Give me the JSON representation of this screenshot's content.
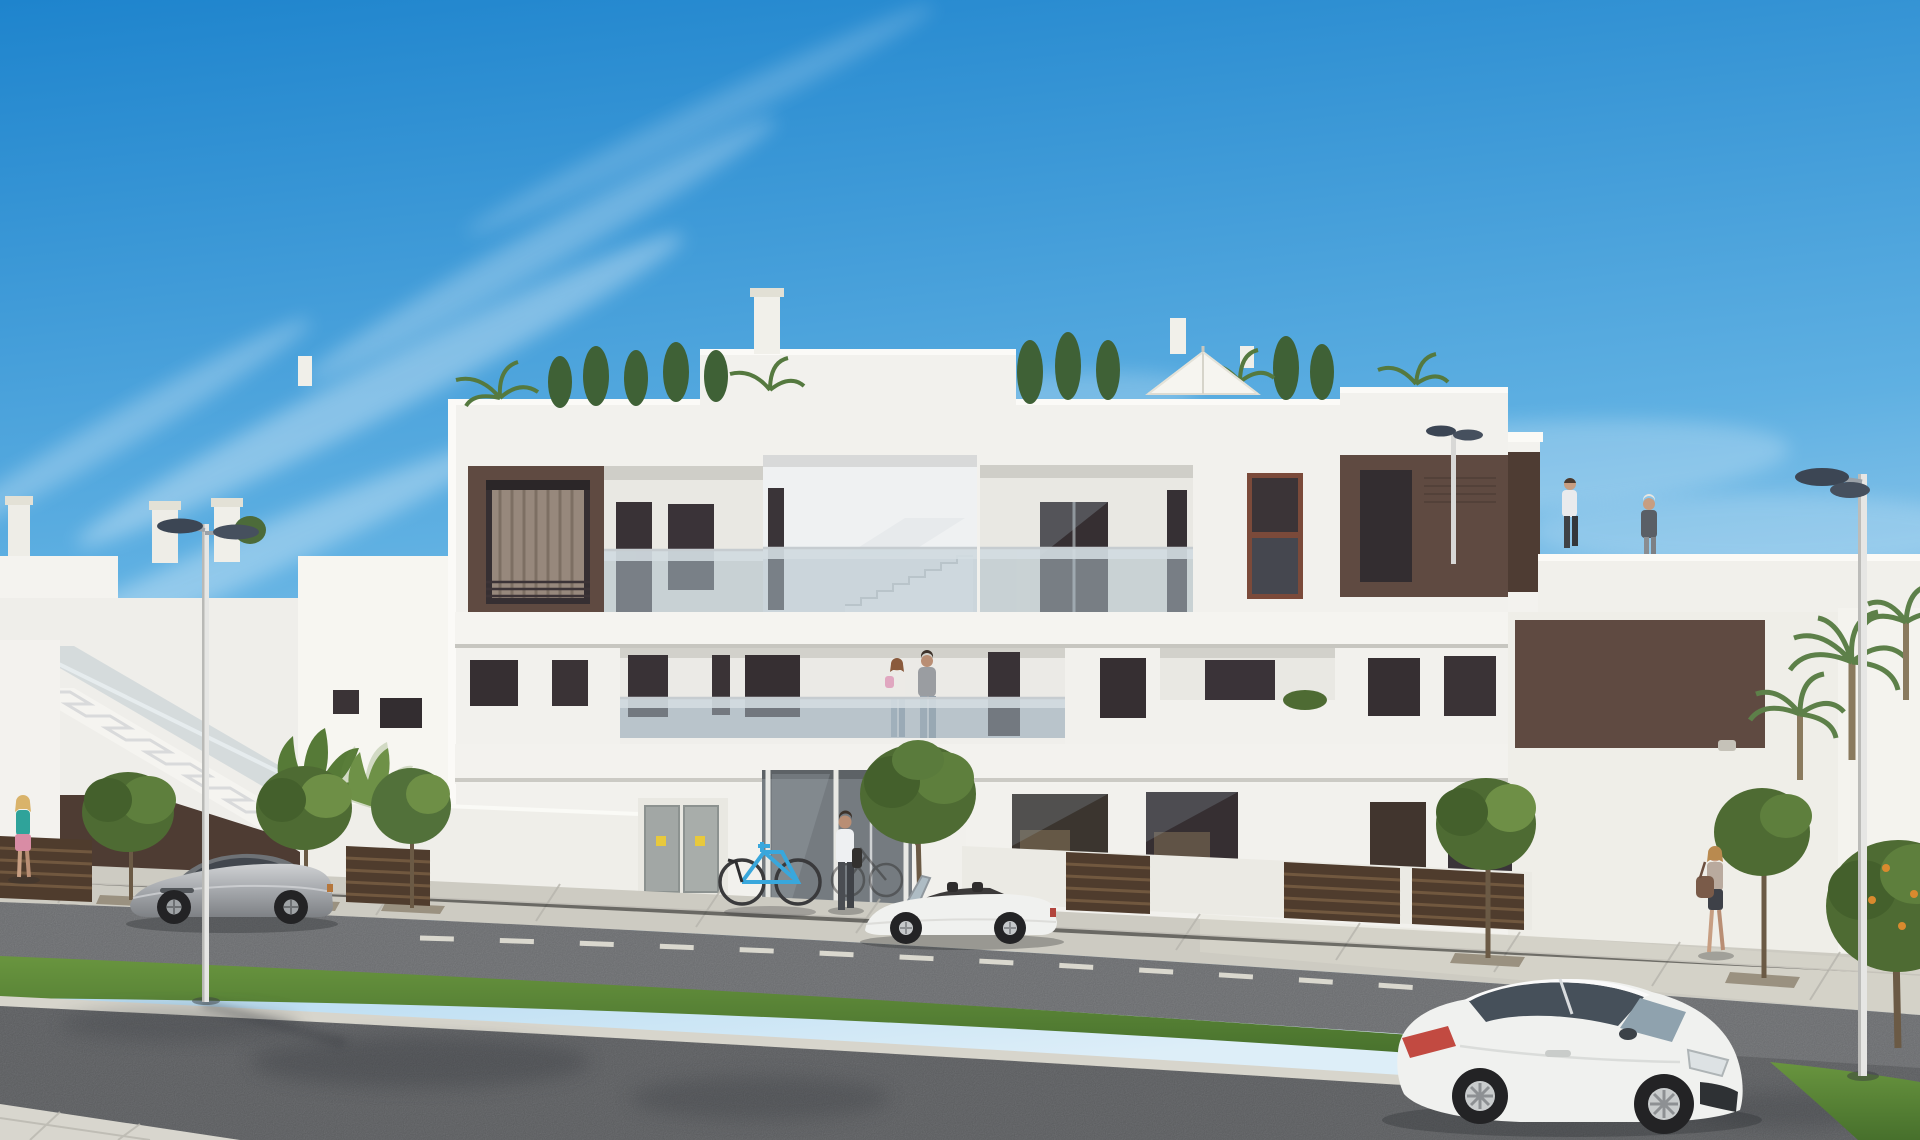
{
  "scene": {
    "kind": "3D architectural render",
    "description": "Modern white three-storey Mediterranean apartment block with dark brown accent panels, glass balcony balustrades, roof terraces with plants and a white parasol; street in front with sidewalk, parked cars, grass median and foreground road under a clear blue sky with thin cirrus clouds",
    "weather": "sunny, clear blue sky",
    "buildings": {
      "main": {
        "storeys": 3,
        "style": "flat-roof modern white render",
        "features": [
          "recessed balconies with glass balustrades",
          "dark brown accent panels",
          "central double-height glazed entrance",
          "open stairwell to roof terrace",
          "roof terrace with cypresses, palms and white parasol",
          "chimney stacks"
        ]
      },
      "left_neighbour": {
        "features": [
          "external staircase with glass balustrade",
          "brown under-stair wall",
          "roof chimneys"
        ]
      },
      "right_neighbour": {
        "features": [
          "roof terrace with two people",
          "large brown facade panel",
          "palm trees"
        ]
      }
    },
    "street": {
      "layers_front_to_back": [
        "foreground road",
        "pale curb",
        "grass median strip",
        "parking road with lane dashes",
        "paved sidewalk",
        "garden walls and brown slat fences"
      ],
      "street_lamps": 3,
      "lane_marking": "white dashed centre line"
    },
    "vehicles": [
      {
        "type": "sports coupe",
        "color": "silver",
        "position": "parked left on far lane, side view facing left"
      },
      {
        "type": "convertible roadster, top down",
        "color": "white",
        "position": "parked centre in front of entrance"
      },
      {
        "type": "sports coupe",
        "color": "white",
        "position": "foreground right, three-quarter front view"
      }
    ],
    "bicycle": {
      "color": "blue",
      "position": "parked at building entrance"
    },
    "people": [
      {
        "label": "woman walking",
        "location": "left sidewalk"
      },
      {
        "label": "man carrying jacket",
        "location": "building entrance"
      },
      {
        "label": "couple with child",
        "location": "first-floor balcony behind glass"
      },
      {
        "label": "man walking",
        "location": "right roof terrace"
      },
      {
        "label": "woman standing",
        "location": "right roof terrace"
      },
      {
        "label": "woman with handbag walking",
        "location": "right sidewalk"
      }
    ],
    "vegetation": {
      "street_trees": 7,
      "palms": 3,
      "planter": "banana plants left of entrance",
      "roof_plants": "cypresses and palm tufts"
    }
  },
  "palette": {
    "sky_top": "#1e84cd",
    "sky_mid": "#5fb0e2",
    "sky_horizon": "#ddeef8",
    "cloud": "#ffffff",
    "wall_white": "#f2f1ed",
    "wall_bright": "#fbfaf7",
    "wall_shadow": "#e4e3dd",
    "recess_back": "#e9e8e3",
    "recess_lower": "#c4c8cc",
    "slab_edge": "#c7c6c0",
    "accent_brown": "#5f4a41",
    "accent_brown_dark": "#4e3c33",
    "window_dark": "#362f32",
    "frame_dark": "#2b2628",
    "curtain": "#97887c",
    "glass_rail": "#aebfc9",
    "glass_rail_top": "#d5dee3",
    "sidewalk": "#cdcbc2",
    "curb": "#d7d5cc",
    "road_upper": "#87898c",
    "road_main": "#77797c",
    "grass": "#69953f",
    "grass_dark": "#47702c",
    "tree_green": "#4e6b33",
    "tree_light": "#6e8f46",
    "palm_green": "#5d8049",
    "trunk": "#6b5a45",
    "fence_brown": "#4f3c2d",
    "fence_slat": "#71583f",
    "lamp_head": "#3c4654",
    "lamp_pole": "#e6e6e4",
    "car_silver": "#a9acb0",
    "car_white": "#f0f1ef",
    "tire": "#26262a",
    "skin": "#c79e82"
  }
}
